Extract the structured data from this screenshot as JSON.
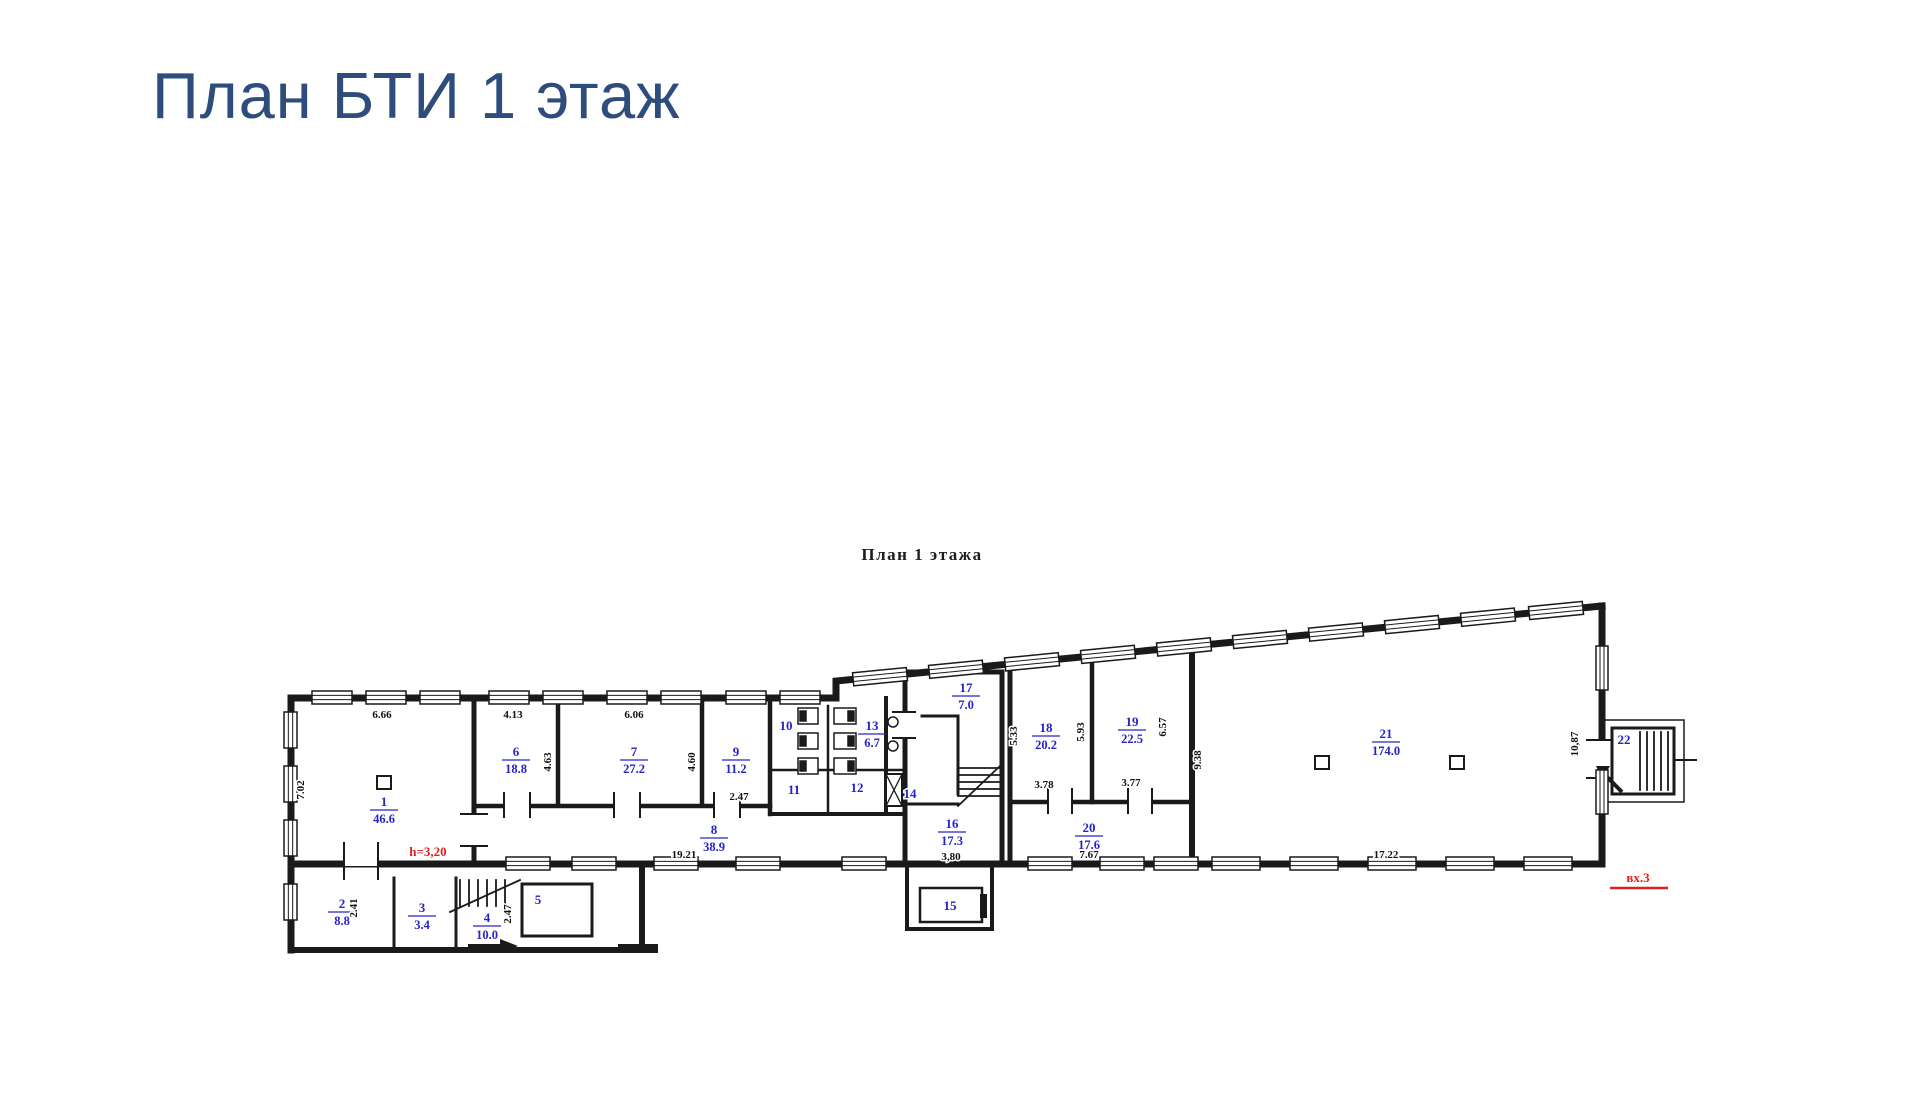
{
  "page": {
    "title": "План БТИ 1 этаж"
  },
  "plan": {
    "subtitle": "План 1 этажа",
    "colors": {
      "title_blue": "#2e4c7c",
      "label_blue": "#2424c8",
      "wall_black": "#1a1a1a",
      "annotation_red": "#e01f1f"
    },
    "annotations": {
      "height_note": "h=3,20",
      "entrance_note": "вх.3"
    },
    "rooms": [
      {
        "number": "1",
        "area": "46.6",
        "x": 384,
        "y": 806
      },
      {
        "number": "2",
        "area": "8.8",
        "x": 342,
        "y": 908
      },
      {
        "number": "3",
        "area": "3.4",
        "x": 422,
        "y": 912
      },
      {
        "number": "4",
        "area": "10.0",
        "x": 487,
        "y": 922
      },
      {
        "number": "5",
        "area": "",
        "x": 538,
        "y": 904
      },
      {
        "number": "6",
        "area": "18.8",
        "x": 516,
        "y": 756
      },
      {
        "number": "7",
        "area": "27.2",
        "x": 634,
        "y": 756
      },
      {
        "number": "8",
        "area": "38.9",
        "x": 714,
        "y": 834
      },
      {
        "number": "9",
        "area": "11.2",
        "x": 736,
        "y": 756
      },
      {
        "number": "10",
        "area": "",
        "x": 786,
        "y": 730
      },
      {
        "number": "11",
        "area": "",
        "x": 794,
        "y": 794
      },
      {
        "number": "12",
        "area": "",
        "x": 857,
        "y": 792
      },
      {
        "number": "13",
        "area": "6.7",
        "x": 872,
        "y": 730
      },
      {
        "number": "14",
        "area": "",
        "x": 910,
        "y": 798
      },
      {
        "number": "15",
        "area": "",
        "x": 950,
        "y": 910
      },
      {
        "number": "16",
        "area": "17.3",
        "x": 952,
        "y": 828
      },
      {
        "number": "17",
        "area": "7.0",
        "x": 966,
        "y": 692
      },
      {
        "number": "18",
        "area": "20.2",
        "x": 1046,
        "y": 732
      },
      {
        "number": "19",
        "area": "22.5",
        "x": 1132,
        "y": 726
      },
      {
        "number": "20",
        "area": "17.6",
        "x": 1089,
        "y": 832
      },
      {
        "number": "21",
        "area": "174.0",
        "x": 1386,
        "y": 738
      },
      {
        "number": "22",
        "area": "",
        "x": 1624,
        "y": 744
      }
    ],
    "dimensions": [
      {
        "text": "6.66",
        "x": 382,
        "y": 718,
        "rotate": false
      },
      {
        "text": "7.02",
        "x": 304,
        "y": 790,
        "rotate": true
      },
      {
        "text": "4.13",
        "x": 513,
        "y": 718,
        "rotate": false
      },
      {
        "text": "4.63",
        "x": 551,
        "y": 762,
        "rotate": true
      },
      {
        "text": "6.06",
        "x": 634,
        "y": 718,
        "rotate": false
      },
      {
        "text": "4.60",
        "x": 695,
        "y": 762,
        "rotate": true
      },
      {
        "text": "2.47",
        "x": 739,
        "y": 800,
        "rotate": false
      },
      {
        "text": "19.21",
        "x": 684,
        "y": 858,
        "rotate": false
      },
      {
        "text": "2.41",
        "x": 357,
        "y": 908,
        "rotate": true
      },
      {
        "text": "2.47",
        "x": 511,
        "y": 914,
        "rotate": true
      },
      {
        "text": "3,80",
        "x": 951,
        "y": 860,
        "rotate": false
      },
      {
        "text": "5.33",
        "x": 1017,
        "y": 736,
        "rotate": true
      },
      {
        "text": "5.93",
        "x": 1084,
        "y": 732,
        "rotate": true
      },
      {
        "text": "6.57",
        "x": 1166,
        "y": 727,
        "rotate": true
      },
      {
        "text": "3.78",
        "x": 1044,
        "y": 788,
        "rotate": false
      },
      {
        "text": "3.77",
        "x": 1131,
        "y": 786,
        "rotate": false
      },
      {
        "text": "9.38",
        "x": 1201,
        "y": 760,
        "rotate": true
      },
      {
        "text": "7.67",
        "x": 1089,
        "y": 858,
        "rotate": false
      },
      {
        "text": "17.22",
        "x": 1386,
        "y": 858,
        "rotate": false
      },
      {
        "text": "10,87",
        "x": 1578,
        "y": 744,
        "rotate": true
      }
    ]
  }
}
